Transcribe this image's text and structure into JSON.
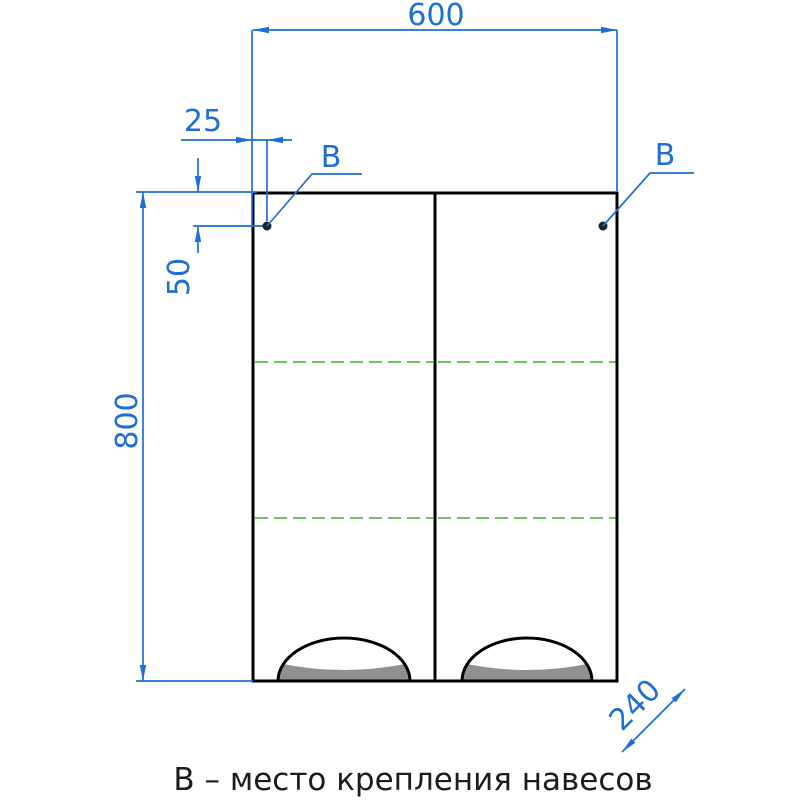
{
  "caption": "В – место крепления навесов",
  "dimensions": {
    "width": "600",
    "hinge_offset_horizontal": "25",
    "hinge_offset_vertical": "50",
    "height": "800",
    "depth": "240"
  },
  "markers": {
    "left": "В",
    "right": "В"
  },
  "colors": {
    "dimension_blue": "#1d6fd6",
    "shelf_dashed_green": "#6fc45e",
    "outline_black": "#000000",
    "glass_shade_gray": "#909090",
    "background": "#ffffff"
  }
}
